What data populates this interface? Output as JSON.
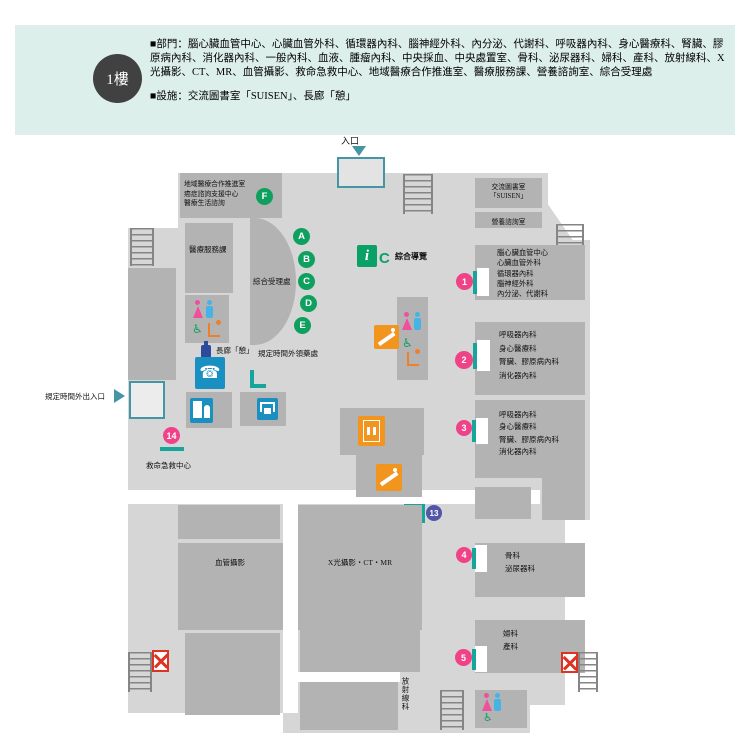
{
  "colors": {
    "header_bg": "#ddefeb",
    "badge_bg": "#414141",
    "floor_light": "#d6d6d6",
    "room_dark": "#b3b3b3",
    "green": "#0fa05f",
    "pink": "#ef4287",
    "indigo": "#5156a8",
    "teal": "#16a59a",
    "entrance_teal": "#4695a5",
    "orange": "#f2951f",
    "blue": "#1a8fc1",
    "red": "#dd3322"
  },
  "header": {
    "floor_badge": "1樓",
    "departments": "■部門：腦心臟血管中心、心臟血管外科、循環器內科、腦神經外科、內分泌、代謝科、呼吸器內科、身心醫療科、腎臟、膠原病內科、消化器內科、一般內科、血液、腫瘤內科、中央採血、中央處置室、骨科、泌尿器科、婦科、產科、放射線科、X光攝影、CT、MR、血管攝影、救命急救中心、地域醫療合作推進室、醫療服務課、營養諮詢室、綜合受理處",
    "facilities": "■設施：交流圖書室「SUISEN」、長廊「憩」"
  },
  "map": {
    "entrance": {
      "top": "入口",
      "after_hours": "規定時間外出入口"
    },
    "info": {
      "icon_letter": "i",
      "marker_letter": "C",
      "label": "綜合導覽"
    },
    "green_markers": [
      "A",
      "B",
      "C",
      "D",
      "E",
      "F"
    ],
    "rooms": {
      "regional_lines": [
        "地域醫療合作推進室",
        "癌症諮詢支援中心",
        "醫療生活諮詢"
      ],
      "medical_services": "醫療服務課",
      "reception": "綜合受理處",
      "library_line1": "交流圖書室",
      "library_line2": "「SUISEN」",
      "nutrition": "營養諮詢室",
      "corridor_rest": "長廊「憩」",
      "after_hours_pharmacy": "規定時間外領藥處",
      "emergency_center": "救命急救中心",
      "angiography": "血管攝影",
      "xray_ct_mr": "X光攝影・CT・MR",
      "radiology": "放射線科"
    },
    "dept_boxes": [
      {
        "num": "1",
        "lines": [
          "腦心臟血管中心",
          "心臟血管外科",
          "循環器內科",
          "腦神經外科",
          "內分泌、代謝科"
        ]
      },
      {
        "num": "2",
        "lines": [
          "呼吸器內科",
          "身心醫療科",
          "腎臟、膠原病內科",
          "消化器內科"
        ]
      },
      {
        "num": "3",
        "lines": [
          "呼吸器內科",
          "身心醫療科",
          "腎臟、膠原病內科",
          "消化器內科"
        ]
      },
      {
        "num": "4",
        "lines": [
          "骨科",
          "泌尿器科"
        ]
      },
      {
        "num": "5",
        "lines": [
          "婦科",
          "產科"
        ]
      }
    ],
    "num_markers": {
      "n13": "13",
      "n14": "14"
    }
  }
}
